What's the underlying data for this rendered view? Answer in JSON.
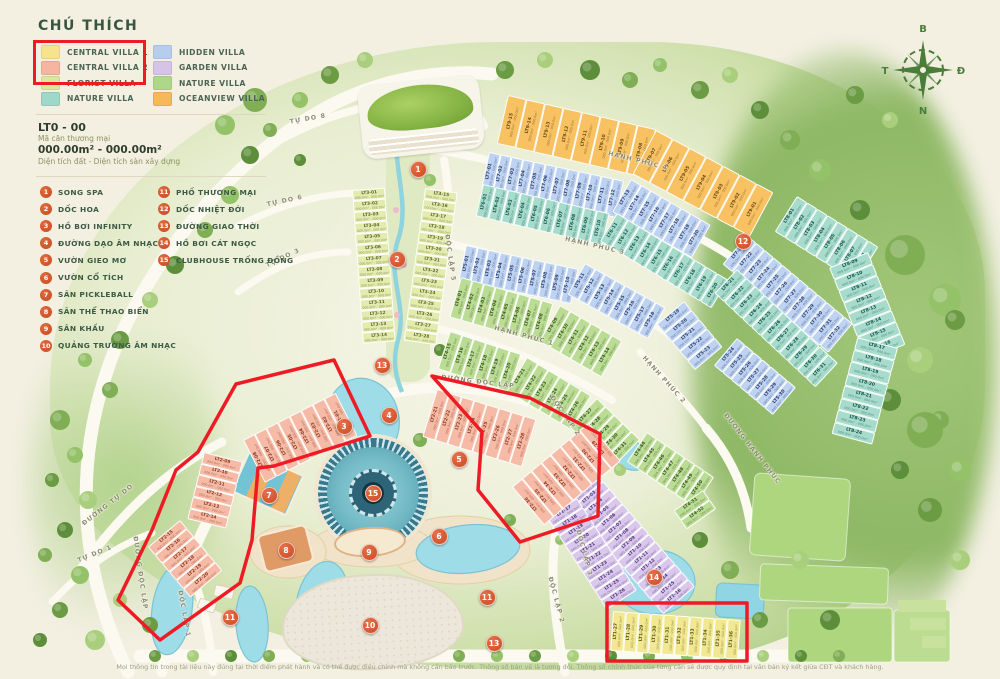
{
  "legend": {
    "title": "CHÚ THÍCH",
    "items": [
      {
        "label": "CENTRAL VILLA 1",
        "color": "#f7e38b",
        "col": 0
      },
      {
        "label": "CENTRAL VILLA 2",
        "color": "#f5b5a0",
        "col": 0
      },
      {
        "label": "FLORIST VILLA",
        "color": "#d9e89e",
        "col": 0
      },
      {
        "label": "NATURE VILLA",
        "color": "#9ed8c8",
        "col": 0
      },
      {
        "label": "HIDDEN VILLA",
        "color": "#b7cdee",
        "col": 1
      },
      {
        "label": "GARDEN VILLA",
        "color": "#d5c3e8",
        "col": 1
      },
      {
        "label": "NATURE VILLA",
        "color": "#afd789",
        "col": 1
      },
      {
        "label": "OCEANVIEW VILLA",
        "color": "#f6b95a",
        "col": 1
      }
    ],
    "highlight_color": "#ee1b24"
  },
  "unit_info": {
    "code": "LT0 - 00",
    "code_desc": "Mã căn thương mại",
    "area": "000.00m² - 000.00m²",
    "area_desc": "Diện tích đất - Diện tích sàn xây dựng"
  },
  "amenities": [
    {
      "num": "1",
      "label": "SONG SPA"
    },
    {
      "num": "2",
      "label": "DỐC HOA"
    },
    {
      "num": "3",
      "label": "HỒ BƠI INFINITY"
    },
    {
      "num": "4",
      "label": "ĐƯỜNG DẠO ÂM NHẠC"
    },
    {
      "num": "5",
      "label": "VƯỜN GIEO MƠ"
    },
    {
      "num": "6",
      "label": "VƯỜN CỔ TÍCH"
    },
    {
      "num": "7",
      "label": "SÂN PICKLEBALL"
    },
    {
      "num": "8",
      "label": "SÂN THỂ THAO BIỂN"
    },
    {
      "num": "9",
      "label": "SÂN KHẤU"
    },
    {
      "num": "10",
      "label": "QUẢNG TRƯỜNG ÂM NHẠC"
    },
    {
      "num": "11",
      "label": "PHỐ THƯƠNG MẠI"
    },
    {
      "num": "12",
      "label": "DỐC NHIỆT ĐỚI"
    },
    {
      "num": "13",
      "label": "ĐƯỜNG GIAO THỜI"
    },
    {
      "num": "14",
      "label": "HỒ BƠI CÁT NGỌC"
    },
    {
      "num": "15",
      "label": "CLUBHOUSE TRỐNG ĐỒNG"
    }
  ],
  "compass": {
    "n": "B",
    "e": "Đ",
    "s": "N",
    "w": "T"
  },
  "footer": {
    "disclaimer": "Mọi thông tin trong tài liệu này đúng tại thời điểm phát hành và có thể được điều chỉnh mà không cần báo trước. Thông số bản vẽ là tương đối. Thông số chính thức của từng căn sẽ được quy định tại văn bản  ký kết giữa CĐT và khách hàng."
  },
  "map": {
    "lot_subtext": "000.0m² - 000.0m²",
    "colors": {
      "flo": {
        "bg": "#e3ecae",
        "tx": "#5f682a"
      },
      "or": {
        "bg": "#f8c263",
        "tx": "#6d4a12"
      },
      "bl": {
        "bg": "#bed2f2",
        "tx": "#2c3f6e"
      },
      "te": {
        "bg": "#a7dccd",
        "tx": "#17564a"
      },
      "gr": {
        "bg": "#bbdc94",
        "tx": "#39591f"
      },
      "pu": {
        "bg": "#d9c7ec",
        "tx": "#50357a"
      },
      "pi": {
        "bg": "#f6bba6",
        "tx": "#8a3a22"
      },
      "ye": {
        "bg": "#f2e891",
        "tx": "#5f5714"
      }
    },
    "road_labels": [
      {
        "t": "TỰ DO 8",
        "x": 308,
        "y": 119,
        "r": -10
      },
      {
        "t": "TỰ DO 6",
        "x": 285,
        "y": 201,
        "r": -12
      },
      {
        "t": "TỰ DO 3",
        "x": 283,
        "y": 258,
        "r": -25
      },
      {
        "t": "ĐƯỜNG TỰ DO",
        "x": 108,
        "y": 505,
        "r": -38
      },
      {
        "t": "TỰ DO 1",
        "x": 95,
        "y": 554,
        "r": -22
      },
      {
        "t": "ĐƯỜNG ĐỘC LẬP",
        "x": 140,
        "y": 573,
        "r": 82
      },
      {
        "t": "ĐỘC LẬP 1",
        "x": 184,
        "y": 614,
        "r": 80
      },
      {
        "t": "ĐƯỜNG ĐỘC LẬP",
        "x": 478,
        "y": 382,
        "r": 7
      },
      {
        "t": "ĐỘC LẬP 5",
        "x": 450,
        "y": 258,
        "r": 82
      },
      {
        "t": "ĐỘC LẬP 2",
        "x": 565,
        "y": 416,
        "r": 55
      },
      {
        "t": "ĐỘC LẬP 2",
        "x": 556,
        "y": 600,
        "r": 75
      },
      {
        "t": "ĐỘC LẬP 3",
        "x": 584,
        "y": 553,
        "r": 75
      },
      {
        "t": "HẠNH PHÚC 4",
        "x": 638,
        "y": 161,
        "r": 14
      },
      {
        "t": "HẠNH PHÚC 3",
        "x": 595,
        "y": 246,
        "r": 13
      },
      {
        "t": "HẠNH PHÚC 1",
        "x": 524,
        "y": 336,
        "r": 15
      },
      {
        "t": "HẠNH PHÚC 2",
        "x": 664,
        "y": 380,
        "r": 48
      },
      {
        "t": "ĐƯỜNG HẠNH PHÚC",
        "x": 752,
        "y": 449,
        "r": 52
      }
    ],
    "markers": [
      {
        "n": "1",
        "x": 417,
        "y": 168
      },
      {
        "n": "2",
        "x": 396,
        "y": 258
      },
      {
        "n": "3",
        "x": 343,
        "y": 425
      },
      {
        "n": "4",
        "x": 388,
        "y": 414
      },
      {
        "n": "5",
        "x": 458,
        "y": 458
      },
      {
        "n": "6",
        "x": 438,
        "y": 535
      },
      {
        "n": "7",
        "x": 268,
        "y": 494
      },
      {
        "n": "8",
        "x": 285,
        "y": 549
      },
      {
        "n": "9",
        "x": 368,
        "y": 551
      },
      {
        "n": "10",
        "x": 369,
        "y": 624
      },
      {
        "n": "11",
        "x": 229,
        "y": 616
      },
      {
        "n": "11",
        "x": 486,
        "y": 596
      },
      {
        "n": "12",
        "x": 742,
        "y": 240
      },
      {
        "n": "13",
        "x": 381,
        "y": 364
      },
      {
        "n": "13",
        "x": 493,
        "y": 642
      },
      {
        "n": "14",
        "x": 653,
        "y": 576
      },
      {
        "n": "15",
        "x": 372,
        "y": 492
      }
    ],
    "clusters": [
      {
        "id": "LT3-L",
        "c": "flo",
        "x": 352,
        "y": 190,
        "rot": -4,
        "o": "h",
        "w": 11,
        "d": 33,
        "labels": [
          "LT3-01",
          "LT3-02",
          "LT3-03",
          "LT3-04",
          "LT3-05",
          "LT3-06",
          "LT3-07",
          "LT3-08",
          "LT3-09",
          "LT3-10",
          "LT3-11",
          "LT3-12",
          "LT3-13",
          "LT3-14"
        ]
      },
      {
        "id": "LT3-R",
        "c": "flo",
        "x": 425,
        "y": 188,
        "rot": 8,
        "o": "h",
        "w": 11,
        "d": 33,
        "labels": [
          "LT3-15",
          "LT3-16",
          "LT3-17",
          "LT3-18",
          "LT3-19",
          "LT3-20",
          "LT3-21",
          "LT3-22",
          "LT3-23",
          "LT3-24",
          "LT3-25",
          "LT3-26",
          "LT3-27",
          "LT3-28"
        ]
      },
      {
        "id": "LT9-A",
        "c": "or",
        "x": 508,
        "y": 95,
        "rot": 13,
        "o": "v",
        "w": 19,
        "d": 50,
        "labels": [
          "LT9-15",
          "LT9-14",
          "LT9-13",
          "LT9-12",
          "LT9-11",
          "LT9-10",
          "LT9-09",
          "LT9-08"
        ]
      },
      {
        "id": "LT9-B",
        "c": "or",
        "x": 656,
        "y": 130,
        "rot": 28,
        "o": "v",
        "w": 19,
        "d": 50,
        "labels": [
          "LT9-07",
          "LT9-06",
          "LT9-05",
          "LT9-04",
          "LT9-03",
          "LT9-02",
          "LT9-01"
        ]
      },
      {
        "id": "LT7-A",
        "c": "bl",
        "x": 489,
        "y": 152,
        "rot": 12,
        "o": "v",
        "w": 11.5,
        "d": 38,
        "labels": [
          "LT7-01",
          "LT7-02",
          "LT7-03",
          "LT7-04",
          "LT7-05",
          "LT7-06",
          "LT7-07",
          "LT7-08",
          "LT7-09",
          "LT7-10",
          "LT7-11",
          "LT7-12"
        ]
      },
      {
        "id": "LT7-B",
        "c": "bl",
        "x": 631,
        "y": 179,
        "rot": 30,
        "o": "v",
        "w": 11.5,
        "d": 38,
        "labels": [
          "LT7-13",
          "LT7-14",
          "LT7-15",
          "LT7-16",
          "LT7-17",
          "LT7-18",
          "LT7-19",
          "LT7-20"
        ]
      },
      {
        "id": "LT7-C",
        "c": "bl",
        "x": 747,
        "y": 235,
        "rot": 40,
        "o": "v",
        "w": 11.5,
        "d": 38,
        "labels": [
          "LT7-21",
          "LT7-22",
          "LT7-23",
          "LT7-24",
          "LT7-25",
          "LT7-26",
          "LT7-27",
          "LT7-28",
          "LT7-29",
          "LT7-30",
          "LT7-31",
          "LT7-32"
        ]
      },
      {
        "id": "LT6-A",
        "c": "te",
        "x": 483,
        "y": 184,
        "rot": 13,
        "o": "v",
        "w": 13,
        "d": 33,
        "labels": [
          "LT6-01",
          "LT6-02",
          "LT6-03",
          "LT6-04",
          "LT6-05",
          "LT6-06",
          "LT6-07",
          "LT6-08",
          "LT6-09",
          "LT6-10"
        ]
      },
      {
        "id": "LT6-B",
        "c": "te",
        "x": 617,
        "y": 213,
        "rot": 31,
        "o": "v",
        "w": 13,
        "d": 33,
        "labels": [
          "LT6-11",
          "LT6-12",
          "LT6-13",
          "LT6-14",
          "LT6-15",
          "LT6-16",
          "LT6-17",
          "LT6-18",
          "LT6-19",
          "LT6-20"
        ]
      },
      {
        "id": "LT6-C",
        "c": "te",
        "x": 737,
        "y": 269,
        "rot": 43,
        "o": "v",
        "w": 12.5,
        "d": 33,
        "labels": [
          "LT6-21",
          "LT6-22",
          "LT6-23",
          "LT6-24",
          "LT6-25",
          "LT6-26",
          "LT6-27",
          "LT6-28",
          "LT6-29",
          "LT6-30",
          "LT6-31"
        ]
      },
      {
        "id": "LT8-A",
        "c": "te",
        "x": 797,
        "y": 196,
        "rot": 32,
        "o": "v",
        "w": 12,
        "d": 42,
        "labels": [
          "LT8-01",
          "LT8-02",
          "LT8-03",
          "LT8-04",
          "LT8-05",
          "LT8-06",
          "LT8-07",
          "LT8-08"
        ]
      },
      {
        "id": "LT8-B",
        "c": "te",
        "x": 868,
        "y": 252,
        "rot": 68,
        "o": "v",
        "w": 12.5,
        "d": 42,
        "labels": [
          "LT8-09",
          "LT8-10",
          "LT8-11",
          "LT8-12",
          "LT8-13",
          "LT8-14",
          "LT8-15",
          "LT8-16"
        ]
      },
      {
        "id": "LT8-C",
        "c": "te",
        "x": 898,
        "y": 348,
        "rot": 105,
        "o": "v",
        "w": 12.5,
        "d": 42,
        "labels": [
          "LT8-17",
          "LT8-18",
          "LT8-19",
          "LT8-20",
          "LT8-21",
          "LT8-22",
          "LT8-23",
          "LT8-24"
        ]
      },
      {
        "id": "LT5-A",
        "c": "bl",
        "x": 466,
        "y": 245,
        "rot": 12,
        "o": "v",
        "w": 11.5,
        "d": 36,
        "labels": [
          "LT5-01",
          "LT5-02",
          "LT5-03",
          "LT5-04",
          "LT5-05",
          "LT5-06",
          "LT5-07",
          "LT5-08",
          "LT5-09",
          "LT5-10"
        ]
      },
      {
        "id": "LT5-B",
        "c": "bl",
        "x": 585,
        "y": 263,
        "rot": 29,
        "o": "v",
        "w": 11.5,
        "d": 36,
        "labels": [
          "LT5-11",
          "LT5-12",
          "LT5-13",
          "LT5-14",
          "LT5-15",
          "LT5-16",
          "LT5-17",
          "LT5-18"
        ]
      },
      {
        "id": "LT5-C",
        "c": "bl",
        "x": 684,
        "y": 301,
        "rot": 50,
        "o": "v",
        "w": 12,
        "d": 36,
        "labels": [
          "LT5-19",
          "LT5-20",
          "LT5-21",
          "LT5-22",
          "LT5-23"
        ]
      },
      {
        "id": "LT5-D",
        "c": "bl",
        "x": 737,
        "y": 338,
        "rot": 40,
        "o": "v",
        "w": 11,
        "d": 36,
        "labels": [
          "LT5-24",
          "LT5-25",
          "LT5-26",
          "LT5-27",
          "LT5-28",
          "LT5-29",
          "LT5-30"
        ]
      },
      {
        "id": "LT4-A",
        "c": "gr",
        "x": 461,
        "y": 277,
        "rot": 16,
        "o": "v",
        "w": 12,
        "d": 42,
        "labels": [
          "LT4-01",
          "LT4-02",
          "LT4-03",
          "LT4-04",
          "LT4-05",
          "LT4-06",
          "LT4-07",
          "LT4-08"
        ]
      },
      {
        "id": "LT4-B",
        "c": "gr",
        "x": 560,
        "y": 305,
        "rot": 30,
        "o": "v",
        "w": 12,
        "d": 42,
        "labels": [
          "LT4-09",
          "LT4-10",
          "LT4-11",
          "LT4-12",
          "LT4-13",
          "LT4-14"
        ]
      },
      {
        "id": "LT4-C",
        "c": "gr",
        "x": 450,
        "y": 331,
        "rot": 18,
        "o": "v",
        "w": 12.5,
        "d": 40,
        "labels": [
          "LT4-15",
          "LT4-16",
          "LT4-17",
          "LT4-18",
          "LT4-19",
          "LT4-20"
        ]
      },
      {
        "id": "LT4-D",
        "c": "gr",
        "x": 527,
        "y": 357,
        "rot": 31,
        "o": "v",
        "w": 12.5,
        "d": 40,
        "labels": [
          "LT4-21",
          "LT4-22",
          "LT4-23",
          "LT4-24",
          "LT4-25",
          "LT4-26"
        ]
      },
      {
        "id": "LT4-E",
        "c": "gr",
        "x": 597,
        "y": 398,
        "rot": 44,
        "o": "v",
        "w": 12,
        "d": 40,
        "labels": [
          "LT4-27",
          "LT4-28",
          "LT4-29",
          "LT4-30",
          "LT4-31"
        ]
      },
      {
        "id": "LT4-F",
        "c": "gr",
        "x": 647,
        "y": 432,
        "rot": 34,
        "o": "v",
        "w": 11.5,
        "d": 36,
        "labels": [
          "LT4-44",
          "LT4-45",
          "LT4-46",
          "LT4-47",
          "LT4-48",
          "LT4-49",
          "LT4-50"
        ]
      },
      {
        "id": "LT4-G",
        "c": "gr",
        "x": 703,
        "y": 490,
        "rot": 55,
        "o": "v",
        "w": 11.5,
        "d": 36,
        "labels": [
          "LT4-51",
          "LT4-52"
        ]
      },
      {
        "id": "LT1-A",
        "c": "pu",
        "x": 590,
        "y": 466,
        "rot": 49,
        "o": "v",
        "w": 10,
        "d": 42,
        "labels": [
          "LT1-01",
          "LT1-02",
          "LT1-03",
          "LT1-04",
          "LT1-05",
          "LT1-06",
          "LT1-07",
          "LT1-08",
          "LT1-09",
          "LT1-10",
          "LT1-11",
          "LT1-12",
          "LT1-13",
          "LT1-14",
          "LT1-15",
          "LT1-16"
        ]
      },
      {
        "id": "LT1-B",
        "c": "pu",
        "x": 577,
        "y": 498,
        "rot": 57,
        "o": "v",
        "w": 11,
        "d": 36,
        "labels": [
          "LT1-17",
          "LT1-18",
          "LT1-19",
          "LT1-20",
          "LT1-21",
          "LT1-22",
          "LT1-23",
          "LT1-24",
          "LT1-25",
          "LT1-26"
        ]
      },
      {
        "id": "LT1-C",
        "c": "ye",
        "x": 613,
        "y": 611,
        "rot": 4,
        "o": "v",
        "w": 12.8,
        "d": 40,
        "labels": [
          "LT1-27",
          "LT1-28",
          "LT1-29",
          "LT1-30",
          "LT1-31",
          "LT1-32",
          "LT1-33",
          "LT1-34",
          "LT1-35",
          "LT1-36"
        ]
      },
      {
        "id": "LT2-A",
        "c": "pi",
        "x": 243,
        "y": 440,
        "rot": -27,
        "o": "v",
        "w": 13,
        "d": 48,
        "labels": [
          "LT2-08",
          "LT2-07",
          "LT2-06",
          "LT2-05",
          "LT2-04",
          "LT2-03",
          "LT2-02",
          "LT2-01"
        ]
      },
      {
        "id": "LT2-B",
        "c": "pi",
        "x": 204,
        "y": 452,
        "rot": 14,
        "o": "h",
        "w": 11.5,
        "d": 40,
        "labels": [
          "LT2-09",
          "LT2-10",
          "LT2-11",
          "LT2-12",
          "LT2-13",
          "LT2-14"
        ]
      },
      {
        "id": "LT2-C",
        "c": "pi",
        "x": 180,
        "y": 520,
        "rot": 50,
        "o": "v",
        "w": 11,
        "d": 42,
        "labels": [
          "LT2-15",
          "LT2-16",
          "LT2-17",
          "LT2-18",
          "LT2-19",
          "LT2-20"
        ]
      },
      {
        "id": "LT2-D",
        "c": "pi",
        "x": 437,
        "y": 389,
        "rot": 17,
        "o": "v",
        "w": 13,
        "d": 50,
        "labels": [
          "LT2-21",
          "LT2-22",
          "LT2-23",
          "LT2-24",
          "LT2-25",
          "LT2-26",
          "LT2-27",
          "LT2-28"
        ]
      },
      {
        "id": "LT2-E",
        "c": "pi",
        "x": 512,
        "y": 487,
        "rot": -40,
        "o": "v",
        "w": 12.5,
        "d": 50,
        "labels": [
          "LT2-36",
          "LT2-35",
          "LT2-34",
          "LT2-33",
          "LT2-32",
          "LT2-31",
          "LT2-30",
          "LT2-29"
        ]
      }
    ]
  }
}
